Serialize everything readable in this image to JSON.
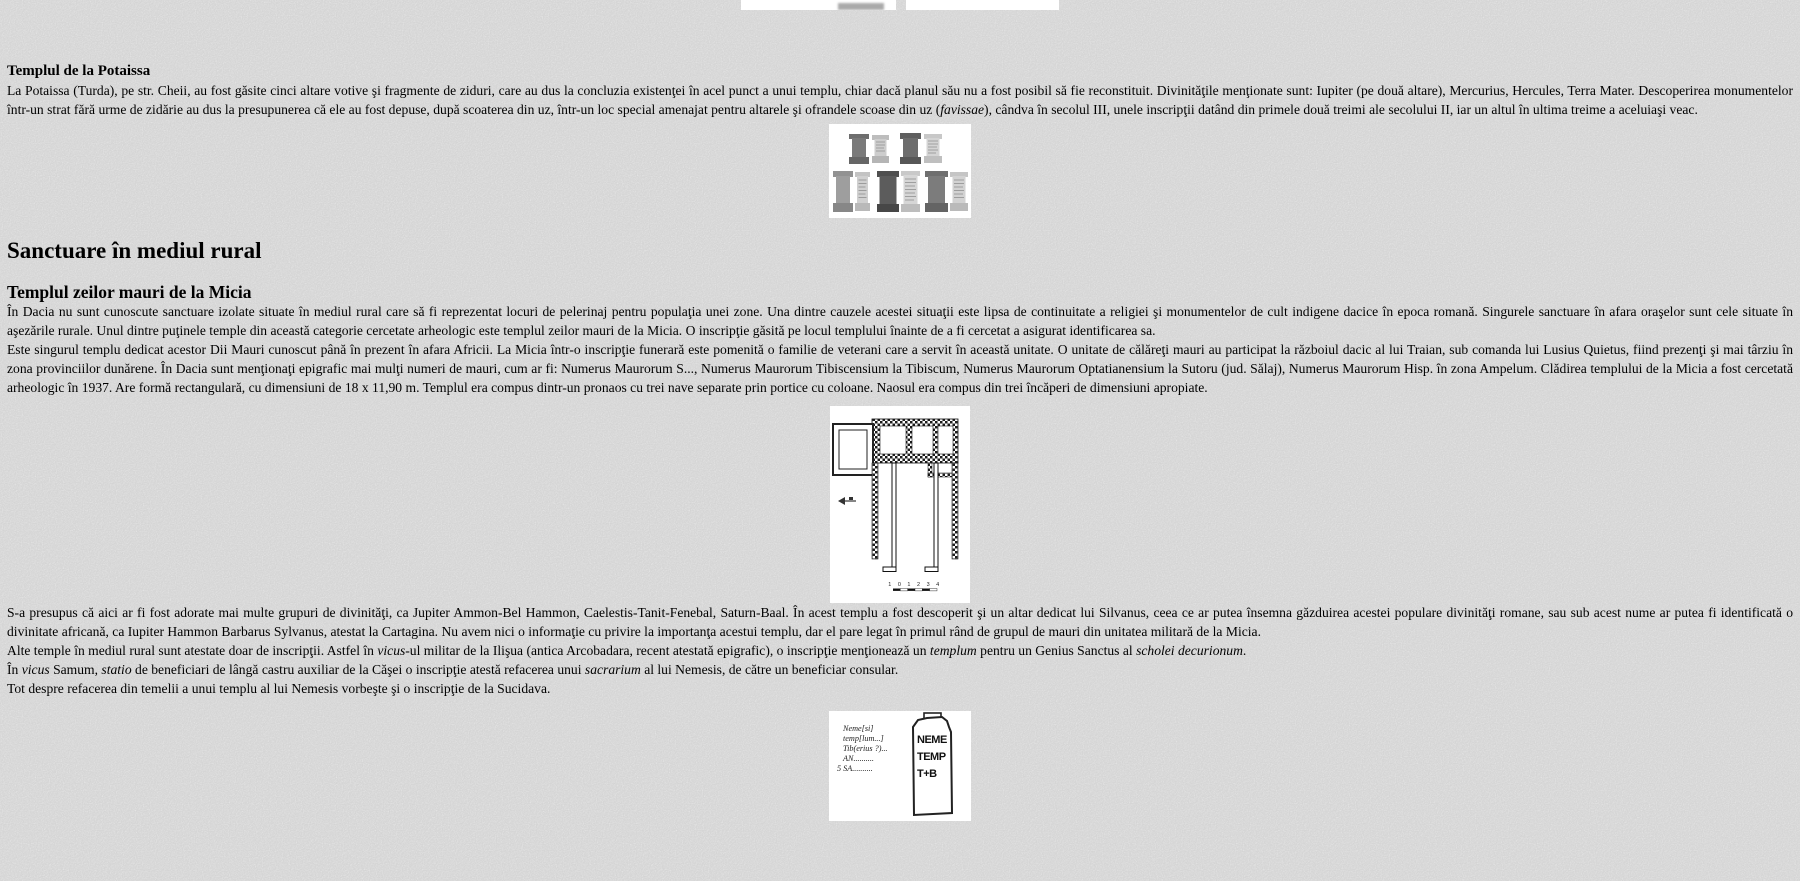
{
  "page": {
    "background_color": "#d4d4d4",
    "text_color": "#000000",
    "figure_background": "#ffffff"
  },
  "content": {
    "potaissa_heading": "Templul de la Potaissa",
    "potaissa_paragraph": [
      {
        "t": "La Potaissa (Turda), pe str. Cheii, au fost găsite cinci altare votive şi fragmente de ziduri, care au dus la concluzia existenţei în acel punct a unui templu, chiar dacă planul său nu a fost posibil să fie reconstituit. Divinităţile menţionate sunt: Iupiter (pe două altare), Mercurius, Hercules, Terra Mater. Descoperirea monumentelor într-un strat fără urme de zidărie au dus la presupunerea că ele au fost depuse, după scoaterea din uz, într-un loc special amenajat pentru altarele şi ofrandele scoase din uz ("
      },
      {
        "t": "favissae",
        "i": true
      },
      {
        "t": "), cândva în secolul III, unele inscripţii datând din primele două treimi ale secolului II, iar un altul în ultima treime a aceluiaşi veac."
      }
    ],
    "rural_heading": "Sanctuare în mediul rural",
    "micia_heading": "Templul zeilor mauri de la Micia",
    "micia_p1": [
      {
        "t": "În Dacia nu sunt cunoscute sanctuare izolate situate în mediul rural care să fi reprezentat locuri de pelerinaj pentru populaţia unei zone. Una dintre cauzele acestei situaţii este lipsa de continuitate a religiei şi monumentelor de cult indigene dacice în epoca romană. Singurele sanctuare în afara oraşelor sunt cele situate în aşezările rurale. Unul dintre puţinele temple din această categorie cercetate arheologic este templul zeilor mauri de la Micia. O inscripţie găsită pe locul templului înainte de a fi cercetat a asigurat identificarea sa."
      }
    ],
    "micia_p2": [
      {
        "t": "Este singurul templu dedicat acestor Dii Mauri cunoscut până în prezent în afara Africii. La Micia într-o inscripţie funerară este pomenită o familie de veterani care a servit în această unitate. O unitate de călăreţi mauri au participat la războiul dacic al lui Traian, sub comanda lui Lusius Quietus, fiind prezenţi şi mai târziu în zona provinciilor dunărene. În Dacia sunt menţionaţi epigrafic mai mulţi numeri de mauri, cum ar fi: Numerus Maurorum S..., Numerus Maurorum Tibiscensium la Tibiscum, Numerus Maurorum Optatianensium la Sutoru (jud. Sălaj), Numerus Maurorum Hisp. în zona Ampelum. Clădirea templului de la Micia a fost cercetată arheologic în 1937. Are formă rectangulară, cu dimensiuni de 18 x 11,90 m. Templul era compus dintr-un pronaos cu trei nave separate prin portice cu coloane. Naosul era compus din trei încăperi de dimensiuni apropiate."
      }
    ],
    "divinities_paragraph": [
      {
        "t": "S-a presupus că aici ar fi fost adorate mai multe grupuri de divinităţi, ca Jupiter Ammon-Bel Hammon, Caelestis-Tanit-Fenebal, Saturn-Baal. În acest templu a fost descoperit şi un altar dedicat lui Silvanus, ceea ce ar putea însemna găzduirea acestei populare divinităţi romane, sau sub acest nume ar putea fi identificată o divinitate africană, ca Iupiter Hammon Barbarus Sylvanus, atestat la Cartagina. Nu avem nici o informaţie cu privire la importanţa acestui templu, dar el pare legat în primul rând de grupul de mauri din unitatea militară de la Micia."
      }
    ],
    "other_temples_paragraph": [
      {
        "t": "Alte temple în mediul rural sunt atestate doar de inscripţii. Astfel în "
      },
      {
        "t": "vicus",
        "i": true
      },
      {
        "t": "-ul militar de la Ilişua (antica Arcobadara, recent atestată epigrafic), o inscripţie menţionează un "
      },
      {
        "t": "templum",
        "i": true
      },
      {
        "t": " pentru un Genius Sanctus al "
      },
      {
        "t": "scholei decurionum",
        "i": true
      },
      {
        "t": "."
      }
    ],
    "samum_paragraph": [
      {
        "t": "În "
      },
      {
        "t": "vicus",
        "i": true
      },
      {
        "t": " Samum, "
      },
      {
        "t": "statio",
        "i": true
      },
      {
        "t": " de beneficiari de lângă castru auxiliar de la Căşei o inscripţie atestă refacerea unui "
      },
      {
        "t": "sacrarium",
        "i": true
      },
      {
        "t": " al lui Nemesis, de către un beneficiar consular."
      }
    ],
    "sucidava_paragraph": [
      {
        "t": "Tot despre refacerea din temelii a unui templu al lui Nemesis vorbeşte şi o inscripţie de la Sucidava."
      }
    ]
  },
  "figures": {
    "temple_plan": {
      "scale_numbers": "1 0 1 2 3 4"
    },
    "inscription": {
      "transcription": [
        "Neme[si]",
        "temp[lum...]",
        "Tib(erius ?)...",
        "AN..........",
        "5 SA.........."
      ],
      "stone_letters": [
        "NEME",
        "TEMP",
        "T+B"
      ]
    }
  }
}
